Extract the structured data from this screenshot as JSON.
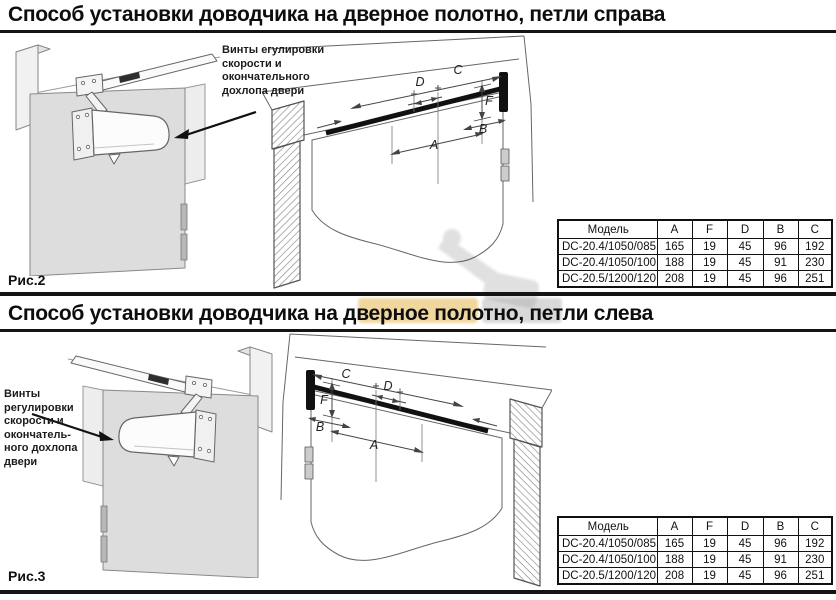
{
  "sections": [
    {
      "title": "Способ установки доводчика на дверное полотно, петли справа",
      "figure_label": "Рис.2",
      "callout_lines": [
        "Винты егулировки",
        "скорости и",
        "окончательного",
        "дохлопа двери"
      ],
      "dim_labels": {
        "a": "A",
        "b": "B",
        "c": "C",
        "d": "D",
        "f": "F"
      },
      "table": {
        "headers": [
          "Модель",
          "A",
          "F",
          "D",
          "B",
          "C"
        ],
        "rows": [
          [
            "DC-20.4/1050/085",
            "165",
            "19",
            "45",
            "96",
            "192"
          ],
          [
            "DC-20.4/1050/100",
            "188",
            "19",
            "45",
            "91",
            "230"
          ],
          [
            "DC-20.5/1200/120",
            "208",
            "19",
            "45",
            "96",
            "251"
          ]
        ]
      }
    },
    {
      "title": "Способ установки доводчика на дверное полотно, петли слева",
      "figure_label": "Рис.3",
      "callout_lines": [
        "Винты",
        "регулировки",
        "скорости и",
        "окончатель-",
        "ного дохлопа",
        "двери"
      ],
      "dim_labels": {
        "a": "A",
        "b": "B",
        "c": "C",
        "d": "D",
        "f": "F"
      },
      "table": {
        "headers": [
          "Модель",
          "A",
          "F",
          "D",
          "B",
          "C"
        ],
        "rows": [
          [
            "DC-20.4/1050/085",
            "165",
            "19",
            "45",
            "96",
            "192"
          ],
          [
            "DC-20.4/1050/100",
            "188",
            "19",
            "45",
            "91",
            "230"
          ],
          [
            "DC-20.5/1200/120",
            "208",
            "19",
            "45",
            "96",
            "251"
          ]
        ]
      }
    }
  ],
  "colors": {
    "rule": "#141414",
    "door_fill": "#dddddd",
    "line_art": "#666666",
    "rail": "#111111",
    "watermark_yellow": "#e3b64f",
    "watermark_gray": "#9c9c9c"
  }
}
